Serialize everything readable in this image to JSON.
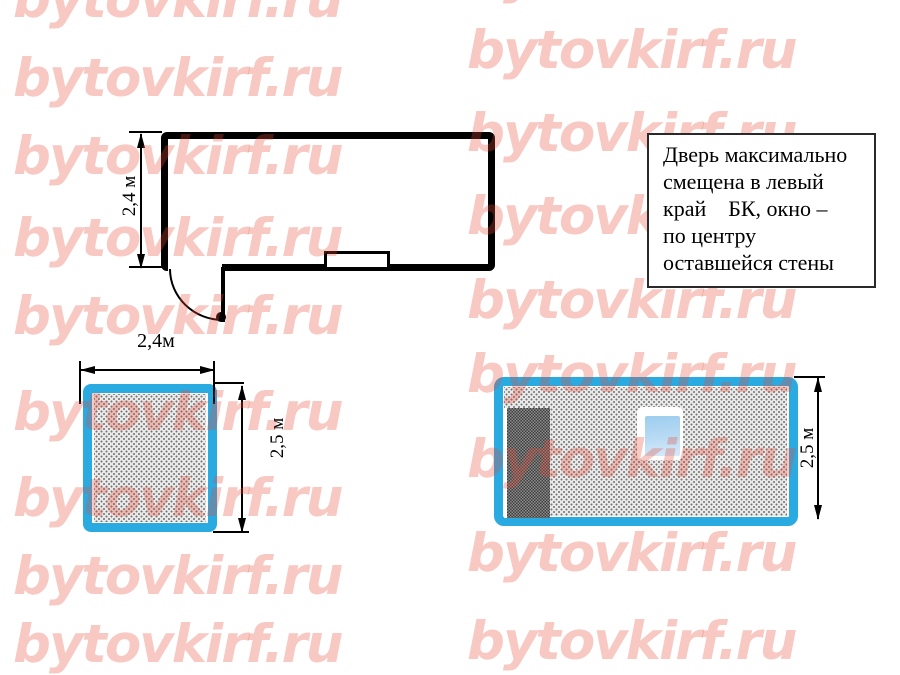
{
  "page": {
    "background": "#FFFFFF"
  },
  "watermark": {
    "text": "bytovkirf.ru",
    "color_hex": "#F9C9C1",
    "tiles": [
      {
        "x": 13,
        "y": -27
      },
      {
        "x": 467,
        "y": -52
      },
      {
        "x": 13,
        "y": 52
      },
      {
        "x": 467,
        "y": 24
      },
      {
        "x": 13,
        "y": 130
      },
      {
        "x": 467,
        "y": 107
      },
      {
        "x": 13,
        "y": 212
      },
      {
        "x": 467,
        "y": 190
      },
      {
        "x": 13,
        "y": 290
      },
      {
        "x": 467,
        "y": 274
      },
      {
        "x": 13,
        "y": 386
      },
      {
        "x": 467,
        "y": 348
      },
      {
        "x": 13,
        "y": 472
      },
      {
        "x": 467,
        "y": 433
      },
      {
        "x": 13,
        "y": 550
      },
      {
        "x": 467,
        "y": 527
      },
      {
        "x": 13,
        "y": 618
      },
      {
        "x": 467,
        "y": 615
      }
    ]
  },
  "floor_plan": {
    "height_dimension_label": "2,4 м"
  },
  "note_box": {
    "lines": [
      "Дверь максимально",
      "смещена в левый",
      "край    БК, окно –",
      "по центру",
      "оставшейся стены"
    ]
  },
  "small_elevation": {
    "width_dimension_label": "2,4м",
    "height_dimension_label": "2,5 м"
  },
  "large_elevation": {
    "height_dimension_label": "2,5 м"
  },
  "colors": {
    "frame_cyan": "#29ABE2",
    "wall_black": "#000000",
    "fill_gray": "#EBEBEB",
    "door_dark": "#5B5B5B",
    "glass_blue": "#9ECDEF"
  }
}
